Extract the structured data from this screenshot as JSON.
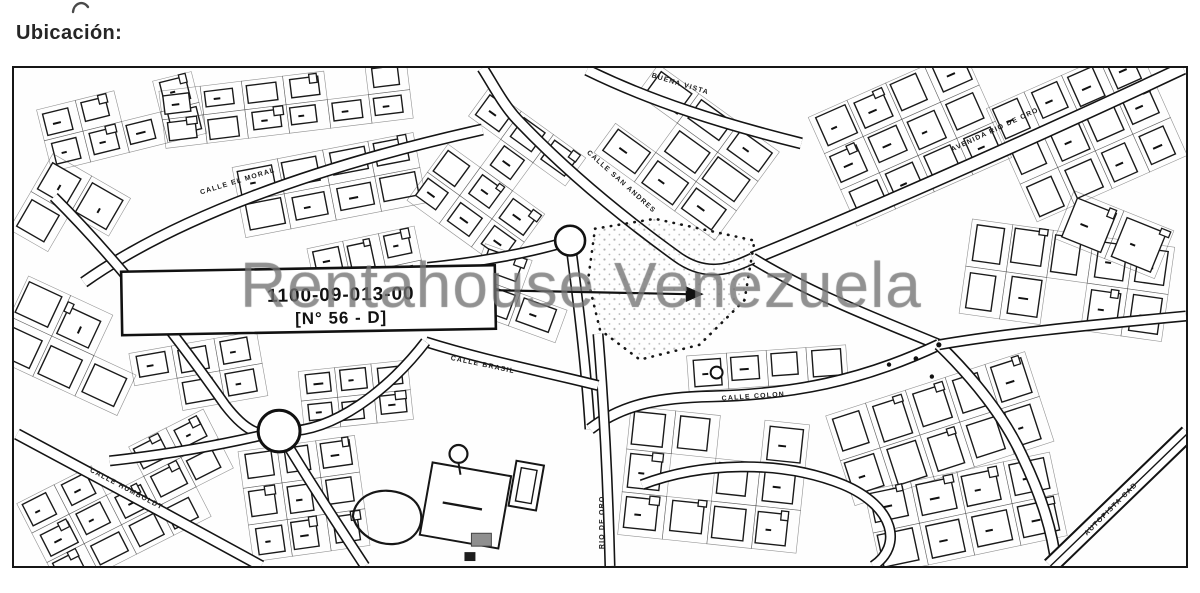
{
  "page": {
    "heading": "Ubicación:"
  },
  "map": {
    "parcel_label": {
      "line1": "1100-09-013-00",
      "line2": "[N° 56 - D]"
    },
    "watermark": "Rentahouse Venezuela",
    "street_labels": [
      {
        "text": "BUENA VISTA"
      },
      {
        "text": "AVENIDA RIO DE ORO"
      },
      {
        "text": "CALLE SAN ANDRES"
      },
      {
        "text": "CALLE EL MORAL"
      },
      {
        "text": "CALLE BRASIL"
      },
      {
        "text": "CALLE COLON"
      },
      {
        "text": "RIO DE ORO"
      },
      {
        "text": "CALLE HUMBOLDT"
      },
      {
        "text": "AUTOPISTA CAB"
      }
    ],
    "colors": {
      "ink": "#1a1a1a",
      "watermark_gray": "#7a7a7a"
    }
  }
}
